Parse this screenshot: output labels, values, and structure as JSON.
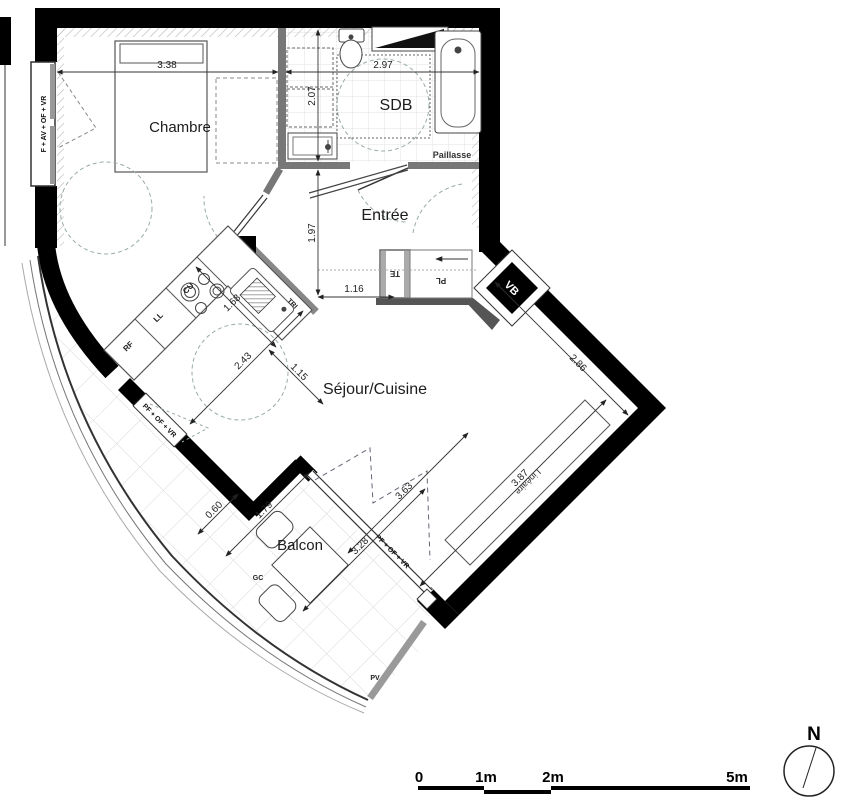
{
  "rooms": {
    "chambre": "Chambre",
    "sdb": "SDB",
    "entree": "Entrée",
    "sejour": "Séjour/Cuisine",
    "balcon": "Balcon"
  },
  "fixtures": {
    "paillasse": "Paillasse",
    "lineaire": "Linéaire"
  },
  "equipment": {
    "te": "TE",
    "pl": "PL",
    "vb": "VB",
    "rf": "RF",
    "ll": "LL",
    "cu": "CU",
    "tri": "TRI",
    "gc": "GC",
    "pv": "PV"
  },
  "windows": {
    "left": "F + AV + OF + VR",
    "kitchen": "PF + OF + VR",
    "balcony": "PF + OF + VR"
  },
  "dimensions": {
    "d338": "3.38",
    "d297": "2.97",
    "d207": "2.07",
    "d197": "1.97",
    "d116": "1.16",
    "d168": "1.68",
    "d243": "2.43",
    "d115": "1.15",
    "d286": "2.86",
    "d363": "3.63",
    "d387": "3.87",
    "d328": "3.28",
    "d179": "1.79",
    "d060": "0.60"
  },
  "scalebar": {
    "t0": "0",
    "t1": "1m",
    "t2": "2m",
    "t5": "5m"
  },
  "compass": {
    "north": "N"
  },
  "colors": {
    "wall": "#000000",
    "line": "#444444",
    "dash": "#98a0ae",
    "tile": "#d9d9d9"
  }
}
